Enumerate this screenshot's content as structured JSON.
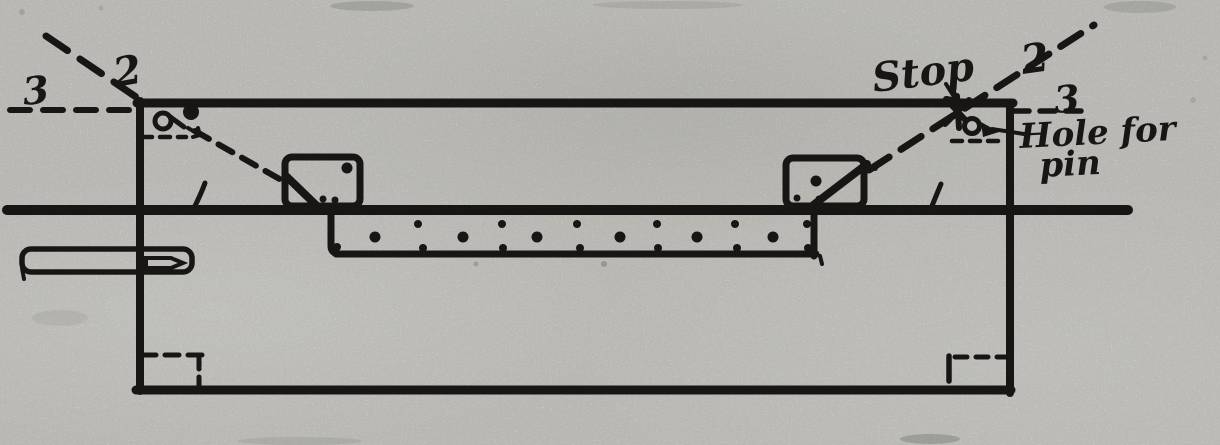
{
  "figure": {
    "kind": "scanned technical drawing, folding table-leg mechanism cross-section",
    "annotations": {
      "left": {
        "position_2": "2",
        "position_3": "3"
      },
      "right": {
        "position_2": "2",
        "position_3": "3",
        "stop": "Stop",
        "hole_for_pin_line1": "Hole for",
        "hole_for_pin_line2": "pin"
      }
    },
    "colors": {
      "ink": "#1b1a18",
      "paper": "#d8d7d2"
    }
  }
}
